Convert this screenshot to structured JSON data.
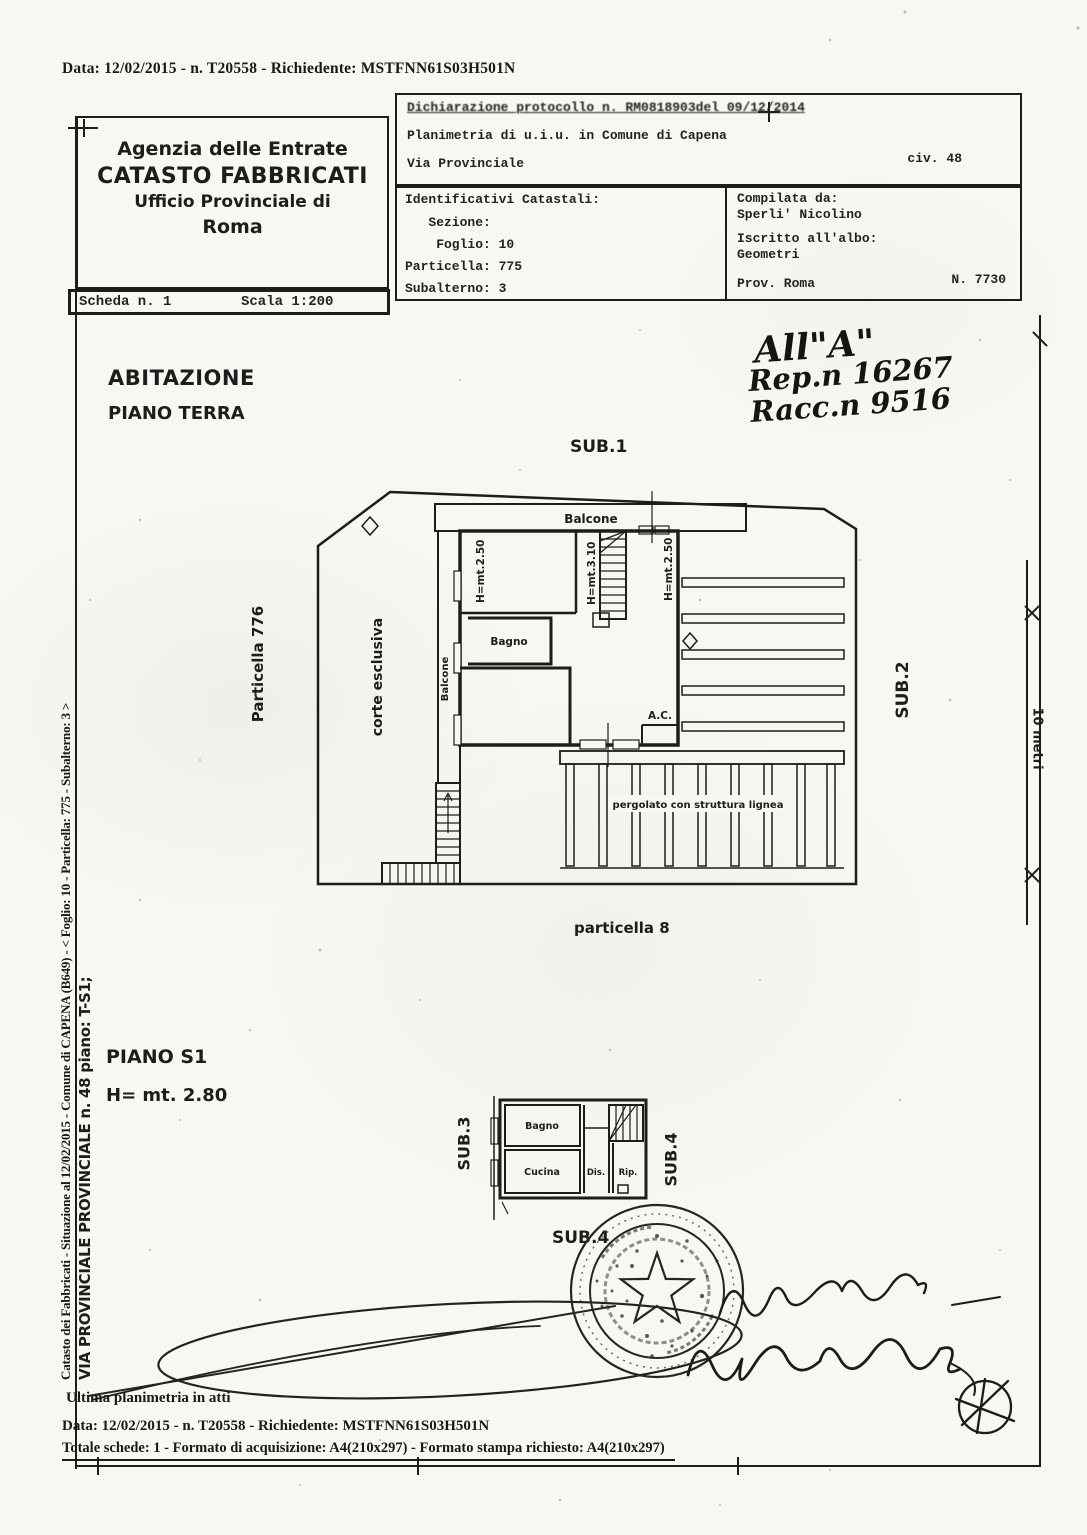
{
  "colors": {
    "ink": "#1d1d1b",
    "paper": "#f7f7f3"
  },
  "doc": {
    "top_line": "Data: 12/02/2015 - n. T20558 - Richiedente: MSTFNN61S03H501N",
    "agency": {
      "l1": "Agenzia delle Entrate",
      "l2": "CATASTO FABBRICATI",
      "l3": "Ufficio Provinciale di",
      "l4": "Roma"
    },
    "scheda": "Scheda n. 1",
    "scala": "Scala 1:200",
    "protocol": {
      "row1": "Dichiarazione protocollo n. RM0818903del  09/12/2014",
      "row2": "Planimetria di u.i.u. in Comune di Capena",
      "via": "Via Provinciale",
      "civ": "civ. 48"
    },
    "catastali": {
      "title": "Identificativi Catastali:",
      "sezione": "   Sezione:",
      "foglio": "    Foglio: 10",
      "particella": "Particella: 775",
      "subalterno": "Subalterno: 3"
    },
    "compilata": {
      "label": "Compilata da:",
      "name": "Sperli' Nicolino",
      "albo_label": "Iscritto all'albo:",
      "albo": "Geometri",
      "prov": "Prov. Roma",
      "num": "N. 7730"
    }
  },
  "annotations": {
    "all_a": "All\"A\"",
    "rep": "Rep.n 16267",
    "racc": "Racc.n 9516"
  },
  "plan_terra": {
    "title1": "ABITAZIONE",
    "title2": "PIANO TERRA",
    "sub1": "SUB.1",
    "sub2": "SUB.2",
    "particella_adjacent": "Particella 776",
    "corte": "corte esclusiva",
    "balcone_top": "Balcone",
    "balcone_left": "Balcone",
    "h_room_left": "H=mt.2.50",
    "h_stairs": "H=mt.3.10",
    "h_room_right": "H=mt.2.50",
    "bagno": "Bagno",
    "ac": "A.C.",
    "pergolato": "pergolato con struttura lignea",
    "particella_below": "particella 8"
  },
  "plan_s1": {
    "title1": "PIANO S1",
    "title2": "H= mt. 2.80",
    "sub3": "SUB.3",
    "sub4_right": "SUB.4",
    "sub4_below": "SUB.4",
    "bagno": "Bagno",
    "cucina": "Cucina",
    "dis": "Dis.",
    "rip": "Rip."
  },
  "margins": {
    "left_line1": "Catasto dei Fabbricati - Situazione al 12/02/2015 - Comune di CAPENA (B649) - < Foglio: 10 - Particella: 775 - Subalterno: 3 >",
    "left_line2": "VIA PROVINCIALE PROVINCIALE n. 48 piano: T-S1;",
    "scale_label": "10 metri"
  },
  "footer": {
    "ultima": "Ultima planimetria in atti",
    "data_line": "Data: 12/02/2015 - n. T20558 - Richiedente: MSTFNN61S03H501N",
    "totale_line": "Totale schede: 1 - Formato di acquisizione: A4(210x297)  - Formato stampa richiesto: A4(210x297)"
  }
}
